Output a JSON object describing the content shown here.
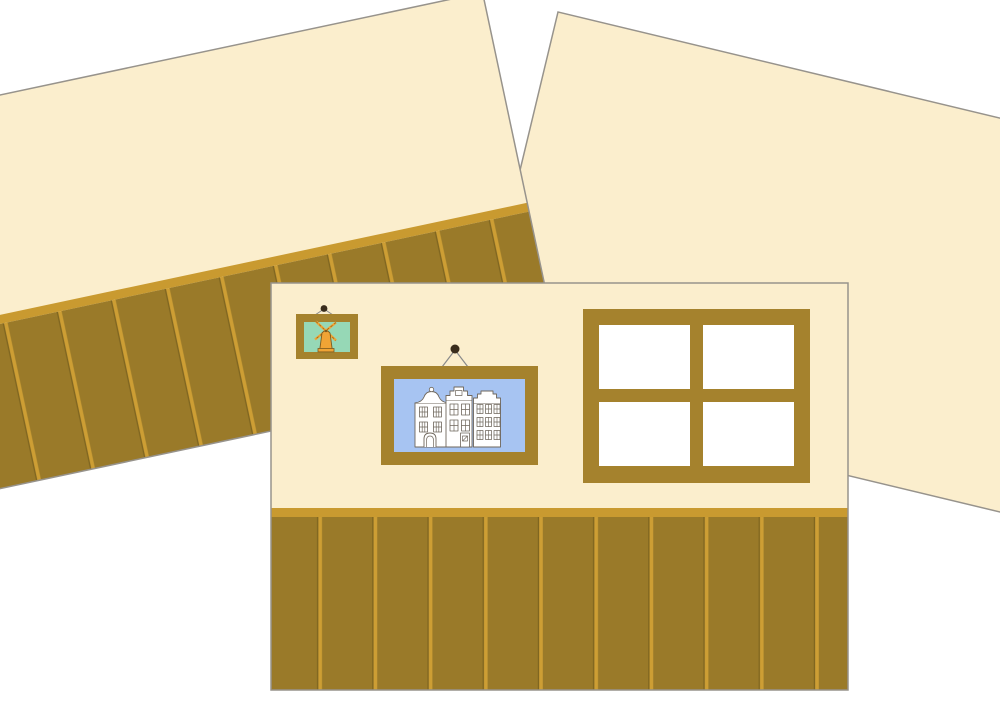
{
  "scene": {
    "title": "Paper dollhouse wall panels",
    "background_color": "#ffffff"
  },
  "colors": {
    "wall_cream": "#fbeecd",
    "panel_border": "#97938c",
    "wainscot_dark": "#9a7a29",
    "gold_trim": "#c99a30",
    "stripe_gold": "#cd9e34",
    "stripe_groove": "#7f6520",
    "wood_frame": "#a5822d",
    "window_pane_white": "#ffffff",
    "picture_sky_blue": "#a7c4f2",
    "picture_mint_green": "#96d8b6",
    "windmill_orange": "#f0a435",
    "windmill_outline": "#7c5a1e",
    "nail_black": "#3a2d1c",
    "wire_gray": "#8a8a8a",
    "house_outline": "#6f675c",
    "house_white": "#ffffff"
  },
  "objects": {
    "left_wall_panel": "tilted wall panel with wainscoting",
    "right_wall_panel": "tilted plain wall panel",
    "front_wall_panel": "upright wall panel with window and framed pictures",
    "window": "four-pane window",
    "large_picture": "framed picture of three canal houses",
    "small_picture": "framed picture of a windmill"
  }
}
